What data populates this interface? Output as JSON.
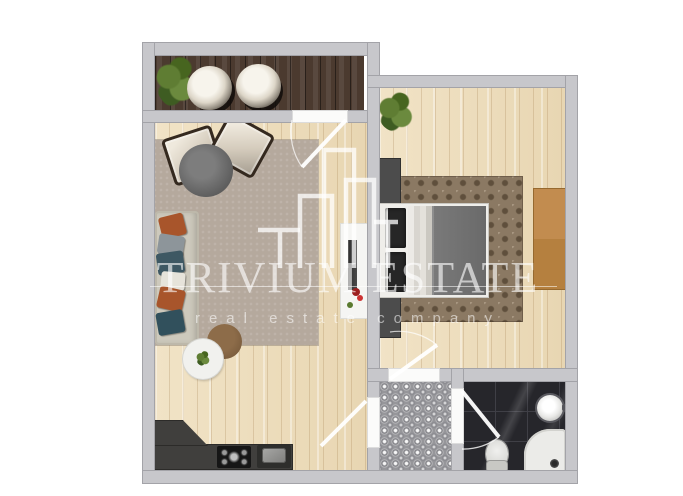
{
  "watermark": {
    "brand": "TRIVIUM ESTATE",
    "tagline": "real estate company",
    "color": "#ffffff",
    "logo": "buildings-outline-icon"
  },
  "palette": {
    "wall": "#c7c7cb",
    "light_wood_floor": "#ecdcbb",
    "balcony_dark_wood": "#4b3a2f",
    "hallway_tile": "#96969a",
    "bathroom_tile": "#26262b",
    "living_rug": "#b5a99d",
    "bedroom_rug": "#8b7963",
    "kitchen_counter": "#403f3d",
    "wardrobe_wood": "#c28c4f",
    "pillow_orange": "#a8552b",
    "pillow_teal": "#3e5863",
    "blanket_gray": "#6f6f6f"
  },
  "rooms": {
    "balcony": {
      "floor": "dark-wood-planks",
      "furniture": [
        "potted-plant",
        "tub-chair",
        "tub-chair"
      ]
    },
    "living_room": {
      "floor": "light-wood-planks",
      "furniture": [
        "sofa-with-pillows",
        "area-rug",
        "armchair",
        "armchair",
        "round-dining-table",
        "coffee-table",
        "side-table-with-plant",
        "tv-console",
        "kitchen-counter",
        "cooktop",
        "kitchen-sink",
        "door-swing"
      ]
    },
    "bedroom": {
      "floor": "light-wood-planks",
      "furniture": [
        "double-bed",
        "nightstand",
        "nightstand",
        "damask-rug",
        "wardrobe",
        "potted-plant",
        "door-swing"
      ]
    },
    "hallway": {
      "floor": "patterned-gray-tile",
      "furniture": []
    },
    "bathroom": {
      "floor": "dark-marble-tile",
      "furniture": [
        "washbasin",
        "toilet",
        "bathtub",
        "door-swing"
      ]
    }
  }
}
